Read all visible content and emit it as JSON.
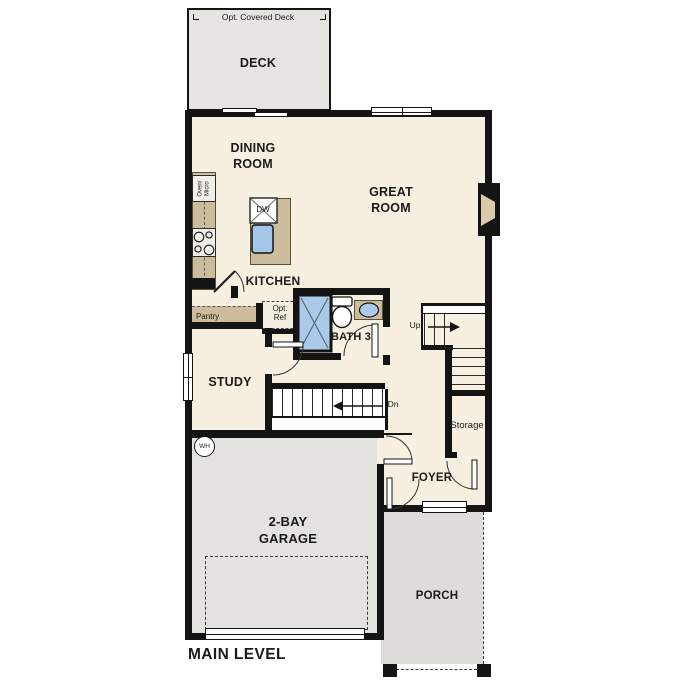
{
  "plan": {
    "title": "MAIN LEVEL",
    "rooms": {
      "deck": {
        "name": "DECK",
        "option_note": "Opt. Covered Deck"
      },
      "dining_room": {
        "name": "DINING ROOM"
      },
      "great_room": {
        "name": "GREAT ROOM"
      },
      "kitchen": {
        "name": "KITCHEN"
      },
      "bath3": {
        "name": "BATH 3"
      },
      "study": {
        "name": "STUDY"
      },
      "storage": {
        "name": "Storage"
      },
      "foyer": {
        "name": "FOYER"
      },
      "garage": {
        "name": "2-BAY GARAGE"
      },
      "porch": {
        "name": "PORCH"
      }
    },
    "fixtures": {
      "oven_micro": "Oven/ Micro",
      "dishwasher": "DW",
      "pantry": "Pantry",
      "opt_ref": "Opt. Ref",
      "water_heater": "WH"
    },
    "stairs": {
      "up": "Up",
      "down": "Dn"
    },
    "colors": {
      "floor": "#f7efe0",
      "deck": "#e5e4e1",
      "garage": "#e3e2df",
      "porch": "#dddcd9",
      "counter": "#ccbc9c",
      "fixture_blue": "#abc9e8",
      "wall": "#141414"
    }
  }
}
